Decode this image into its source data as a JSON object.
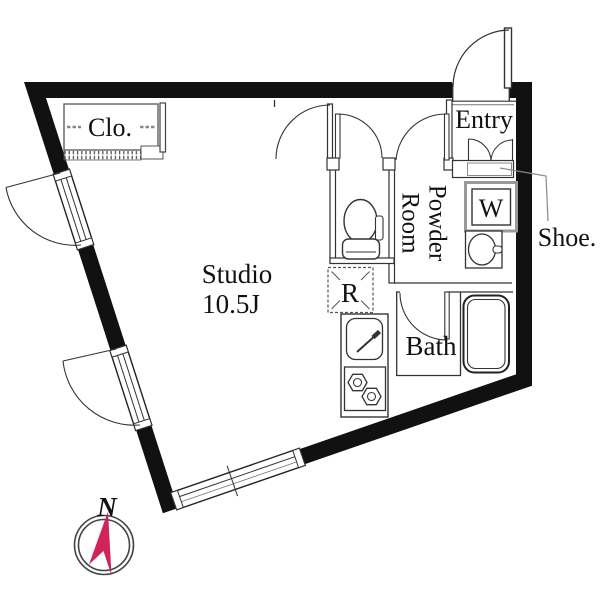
{
  "plan": {
    "closet_label": "Clo.",
    "studio_label": "Studio",
    "studio_size": "10.5J",
    "powder_line1": "Powder",
    "powder_line2": "Room",
    "entry_label": "Entry",
    "washer_label": "W",
    "shoe_label": "Shoe.",
    "fridge_label": "R",
    "bath_label": "Bath",
    "compass_label": "N",
    "compass_color": "#d0235a",
    "wall_color": "#111111",
    "line_color": "#333333"
  }
}
